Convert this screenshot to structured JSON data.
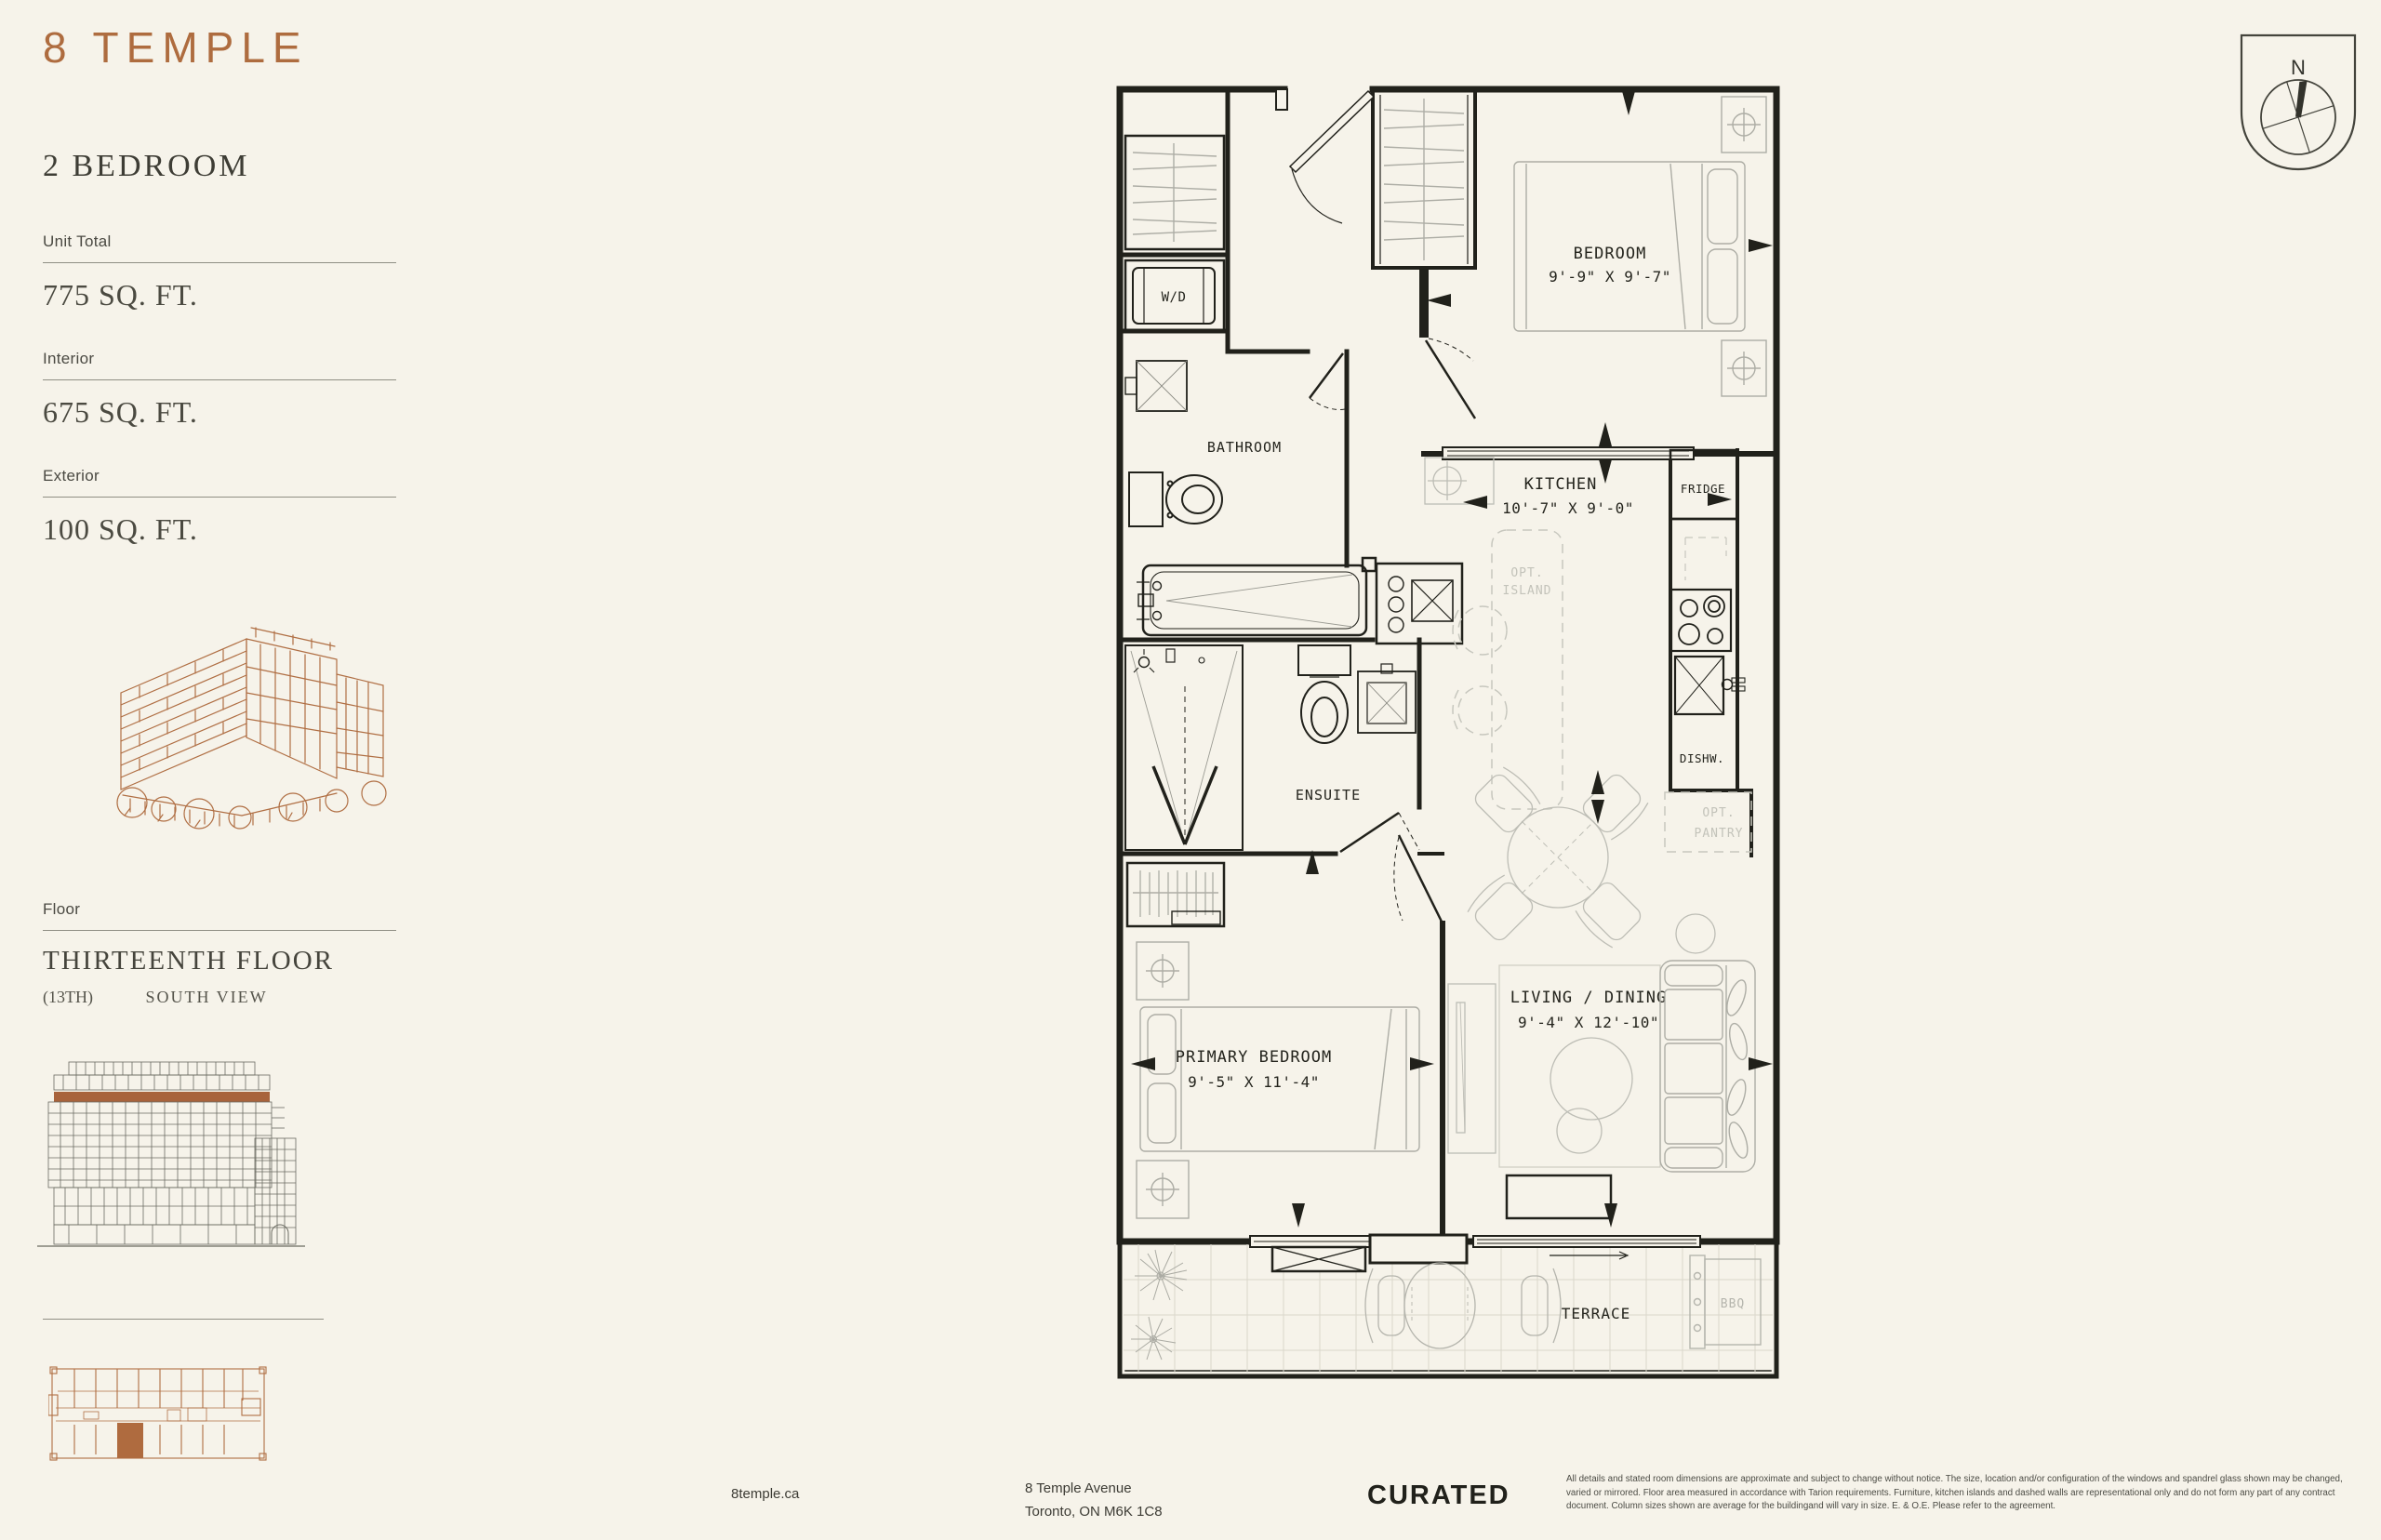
{
  "brand": {
    "logo": "8 TEMPLE",
    "accent_color": "#AE6C3F"
  },
  "unit": {
    "type": "2 BEDROOM",
    "stats": [
      {
        "label": "Unit Total",
        "value": "775 SQ. FT."
      },
      {
        "label": "Interior",
        "value": "675 SQ. FT."
      },
      {
        "label": "Exterior",
        "value": "100 SQ. FT."
      }
    ],
    "floor_label": "Floor",
    "floor_name": "THIRTEENTH FLOOR",
    "floor_number": "(13TH)",
    "view": "SOUTH VIEW"
  },
  "plan": {
    "compass": "N",
    "rooms": {
      "bedroom": {
        "name": "BEDROOM",
        "dims": "9'-9\" X 9'-7\""
      },
      "kitchen": {
        "name": "KITCHEN",
        "dims": "10'-7\" X 9'-0\""
      },
      "bathroom": {
        "name": "BATHROOM"
      },
      "ensuite": {
        "name": "ENSUITE"
      },
      "primary_bedroom": {
        "name": "PRIMARY BEDROOM",
        "dims": "9'-5\" X 11'-4\""
      },
      "living_dining": {
        "name": "LIVING / DINING",
        "dims": "9'-4\" X 12'-10\""
      },
      "terrace": {
        "name": "TERRACE"
      }
    },
    "fixtures": {
      "washer_dryer": "W/D",
      "fridge": "FRIDGE",
      "dishwasher": "DISHW.",
      "opt_island_1": "OPT.",
      "opt_island_2": "ISLAND",
      "opt_pantry_1": "OPT.",
      "opt_pantry_2": "PANTRY",
      "bbq": "BBQ"
    }
  },
  "footer": {
    "website": "8temple.ca",
    "address_line1": "8 Temple Avenue",
    "address_line2": "Toronto, ON M6K 1C8",
    "brand": "CURATED",
    "disclaimer": "All details and stated room dimensions are approximate and subject to change without notice. The size, location and/or configuration of the windows and spandrel glass shown may be changed, varied or mirrored. Floor area measured in accordance with Tarion requirements. Furniture, kitchen islands and dashed walls are representational only and do not form any part of any contract document. Column sizes shown are average for the buildingand will vary in size. E. & O.E. Please refer to the agreement."
  }
}
